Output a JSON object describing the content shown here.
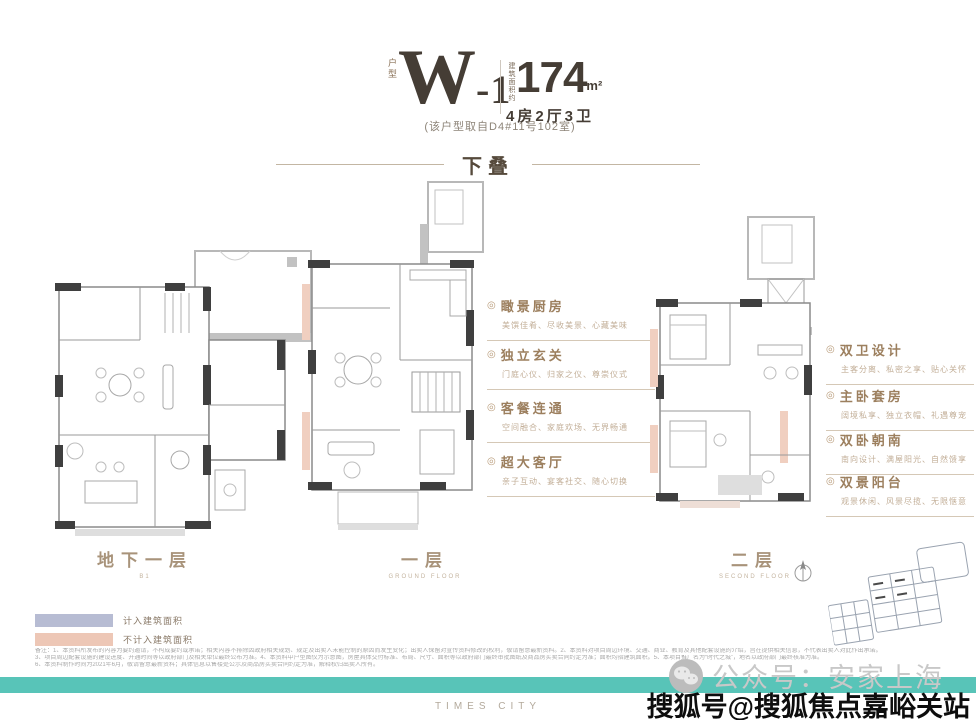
{
  "header": {
    "unit_label": "户型",
    "unit_name_main": "W",
    "unit_name_suffix": "-1",
    "area_prefix": "建筑面积约",
    "area_value": "174",
    "area_unit": "m²",
    "rooms": "4房2厅3卫",
    "source_note": "(该户型取自D4#11号102室)"
  },
  "section_title": "下叠",
  "plans": [
    {
      "label": "地下一层",
      "sublabel": "B1"
    },
    {
      "label": "一层",
      "sublabel": "GROUND FLOOR"
    },
    {
      "label": "二层",
      "sublabel": "SECOND FLOOR"
    }
  ],
  "features_first": [
    {
      "marker": "◎",
      "title": "瞰景厨房",
      "desc": "美馔佳肴、尽收美景、心藏美味"
    },
    {
      "marker": "◎",
      "title": "独立玄关",
      "desc": "门庭心仪、归家之仪、尊崇仪式"
    },
    {
      "marker": "◎",
      "title": "客餐连通",
      "desc": "空间融合、家庭欢场、无界畅通"
    },
    {
      "marker": "◎",
      "title": "超大客厅",
      "desc": "亲子互动、宴客社交、随心切换"
    }
  ],
  "features_second": [
    {
      "marker": "◎",
      "title": "双卫设计",
      "desc": "主客分离、私密之享、贴心关怀"
    },
    {
      "marker": "◎",
      "title": "主卧套房",
      "desc": "阔境私享、独立衣帽、礼遇尊宠"
    },
    {
      "marker": "◎",
      "title": "双卧朝南",
      "desc": "南向设计、满屋阳光、自然馈享"
    },
    {
      "marker": "◎",
      "title": "双景阳台",
      "desc": "观景休闲、风景尽揽、无限惬意"
    }
  ],
  "legend": {
    "items": [
      {
        "label": "计入建筑面积",
        "color": "#b7bcd3"
      },
      {
        "label": "不计入建筑面积",
        "color": "#edc7b6"
      }
    ]
  },
  "disclaimer": {
    "line1": "备注：1、本资料所发布的内容为要约邀请，不构成要约或承诺；相关内容不排除因政府相关规划、规定及出卖人未能控制的原因而发生变化；出卖人保留对宣传资料修改的权利，敬请留意最新资料。2、本资料对项目周边环境、交通、商业、教育及其他配套设施的介绍，旨在提供相关信息，不代表出卖人对此作出承诺。",
    "line2": "3、项目周边配套设施的建设进度、开通时间等以政府部门及相关单位最终公布为准。4、本资料中户型图仅为示意图，房屋具体交付标准、布局、尺寸、面积等以政府部门最终审批图纸及商品房买卖合同约定为准；面积均指建筑面积。5、本项目推广名为“时代之城”，地名以政府部门最终核准为准。",
    "line3": "6、本资料制作时间为2021年6月，敬请留意最新资料；具体信息以售楼处公示及商品房买卖合同约定为准，解释权归出卖人所有。"
  },
  "watermark": {
    "wechat_label": "公众号：安家上海",
    "sohu_label": "搜狐号@搜狐焦点嘉峪关站"
  },
  "footer": {
    "brand": "TIMES CITY"
  },
  "colors": {
    "teal_bar": "#58c4b8",
    "feature_heading": "#9c7f5e",
    "legend_lavender": "#b7bcd3",
    "legend_salmon": "#edc7b6",
    "plan_salmon": "#f0cfc0",
    "title_text": "#453d35"
  }
}
